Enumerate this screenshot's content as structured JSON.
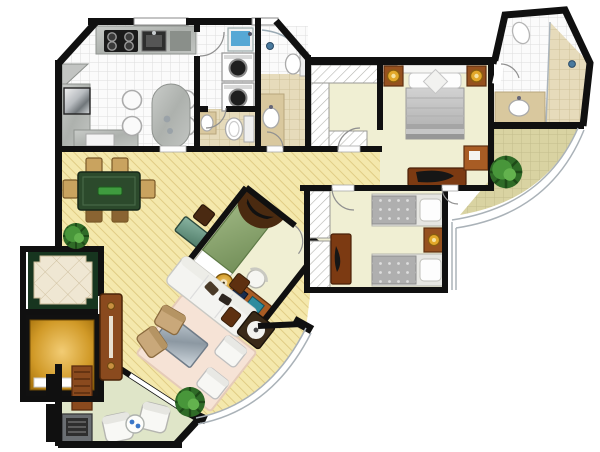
{
  "plan": {
    "title": "apartment-floor-plan",
    "rooms": [
      {
        "id": "kitchen",
        "floor": "white-tile",
        "furniture": [
          "stove-4-burner",
          "sink",
          "granite-counter",
          "refrigerator",
          "breakfast-peninsula",
          "stool",
          "stool",
          "stool",
          "stool"
        ]
      },
      {
        "id": "laundry",
        "floor": "white-tile",
        "furniture": [
          "laundry-tub",
          "washer",
          "dryer"
        ]
      },
      {
        "id": "guest-wc",
        "floor": "beige-tile",
        "furniture": [
          "washbasin",
          "toilet"
        ]
      },
      {
        "id": "bathroom",
        "floor": "beige-tile",
        "furniture": [
          "curved-shower",
          "washbasin",
          "toilet"
        ]
      },
      {
        "id": "master-suite",
        "floor": "cream",
        "furniture": [
          "double-bed",
          "nightstand",
          "nightstand",
          "lamp",
          "lamp",
          "walk-in-closet",
          "dresser-tv",
          "desk"
        ]
      },
      {
        "id": "ensuite-bathroom",
        "floor": "white-tile",
        "furniture": [
          "shower",
          "washbasin",
          "toilet"
        ]
      },
      {
        "id": "twin-bedroom",
        "floor": "cream",
        "furniture": [
          "single-bed",
          "single-bed",
          "nightstand",
          "lamp",
          "dresser-tv",
          "wardrobe"
        ]
      },
      {
        "id": "third-bedroom-office",
        "floor": "cream",
        "furniture": [
          "single-bed",
          "canopy-shelf",
          "desk",
          "printer",
          "chair",
          "stool",
          "wardrobe"
        ]
      },
      {
        "id": "dining-room",
        "floor": "wood",
        "furniture": [
          "dining-table",
          "chair",
          "chair",
          "chair",
          "chair",
          "chair",
          "chair",
          "console-desk",
          "chair",
          "chair",
          "plant"
        ]
      },
      {
        "id": "living-room",
        "floor": "wood",
        "furniture": [
          "l-sofa",
          "armchair",
          "armchair",
          "tan-chair",
          "tan-chair",
          "coffee-table",
          "rug",
          "side-table",
          "side-table",
          "round-lamp-table",
          "plant"
        ]
      },
      {
        "id": "entry-hall",
        "floor": "decorative-marble",
        "furniture": [
          "pivot-entry-door"
        ]
      },
      {
        "id": "elevator",
        "furniture": [
          "elevator-car"
        ]
      },
      {
        "id": "service-terrace",
        "floor": "pale-green",
        "furniture": [
          "bbq-grill",
          "slatted-door",
          "outdoor-chair",
          "outdoor-chair",
          "drinks-table"
        ]
      },
      {
        "id": "balcony",
        "furniture": [
          "plant",
          "glass-railing"
        ]
      }
    ]
  },
  "palette": {
    "wall": "#101010",
    "wood_floor": "#F4E8AC",
    "wood_stripe": "#E0CC85",
    "bedroom_floor": "#F0EFD3",
    "balcony_khaki": "#D9D3A2",
    "terrace_green": "#DFE5C8",
    "marble_cream": "#EFE7D3",
    "marble_border": "#17351F",
    "elevator_gold": "#C9941C",
    "door_brown": "#8A4A1E",
    "furniture_brown": "#96511F",
    "table_green": "#2C4A2C",
    "runner_green": "#3F9B3F",
    "bed_gray": "#BEBEBE",
    "bed_green": "#8FA873",
    "console_teal": "#5F8F7D",
    "sofa_white": "#F4F4F1",
    "rug_pink": "#F6E3D6",
    "glass_table": "#9FACB6",
    "lamp_gold": "#D9A125",
    "plant_green": "#3C8A30",
    "water_blue": "#57A8D5"
  }
}
